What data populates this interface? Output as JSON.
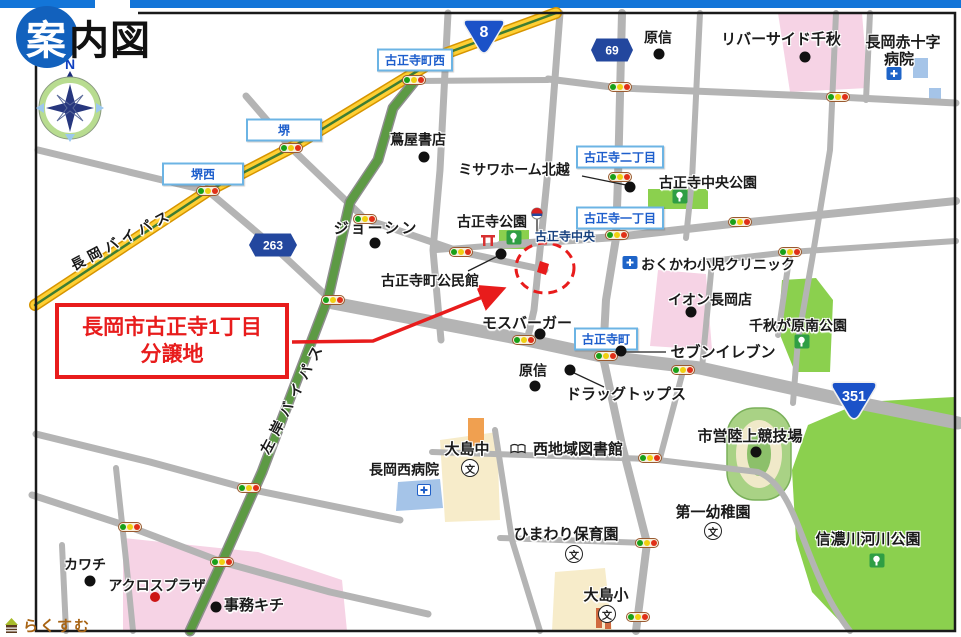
{
  "page": {
    "title_char1": "案",
    "title_rest": "内図",
    "logo_text": "らくすむ",
    "compass_north": "N"
  },
  "site_callout": {
    "line1": "長岡市古正寺1丁目",
    "line2": "分譲地"
  },
  "colors": {
    "accent_red": "#e81c1c",
    "route_shield_blue": "#1b52c8",
    "hex_shield_blue": "#23479e",
    "intersection_text_blue": "#1d5ecc",
    "intersection_border_blue": "#6cb4e4",
    "road_gray": "#b4b4b4",
    "bypass_yellow": "#ffcf33",
    "bypass_green": "#5d9a44",
    "park_green": "#8bd04e",
    "building_pink": "#f6d3e5",
    "building_cream": "#f7ecca",
    "building_blue": "#a5c4e8",
    "topbar_blue": "#1375d8",
    "title_circle_blue": "#1261bd"
  },
  "route_shields": [
    {
      "shape": "triangle",
      "num": "8",
      "x": 484,
      "y": 36,
      "w": 42,
      "h": 36,
      "fs": 16
    },
    {
      "shape": "triangle",
      "num": "351",
      "x": 854,
      "y": 400,
      "w": 52,
      "h": 40,
      "fs": 13
    },
    {
      "shape": "hex",
      "num": "69",
      "x": 612,
      "y": 50,
      "w": 42,
      "h": 23,
      "fs": 12
    },
    {
      "shape": "hex",
      "num": "263",
      "x": 273,
      "y": 245,
      "w": 48,
      "h": 23,
      "fs": 12
    }
  ],
  "intersections": [
    {
      "text": "古正寺町西",
      "x": 415,
      "y": 60
    },
    {
      "text": "堺",
      "x": 284,
      "y": 130,
      "w": 60
    },
    {
      "text": "堺西",
      "x": 203,
      "y": 174,
      "w": 66
    },
    {
      "text": "古正寺二丁目",
      "x": 620,
      "y": 157
    },
    {
      "text": "古正寺一丁目",
      "x": 620,
      "y": 218
    },
    {
      "text": "古正寺町",
      "x": 606,
      "y": 339
    }
  ],
  "places": [
    {
      "text": "長岡バイパス",
      "x": 122,
      "y": 240,
      "rot": -28,
      "ls": 5,
      "fs": 14,
      "name": "road-name-nagaoka-bypass"
    },
    {
      "text": "左岸バイパス",
      "x": 293,
      "y": 397,
      "rot": -63,
      "ls": 7,
      "fs": 14,
      "name": "road-name-sagan-bypass"
    },
    {
      "text": "古正寺中央",
      "x": 565,
      "y": 237,
      "fs": 12,
      "color": "#16407e",
      "name": "intersection-koshoji-chuo"
    },
    {
      "text": "蔦屋書店",
      "x": 418,
      "y": 140,
      "fs": 14
    },
    {
      "text": "ミサワホーム北越",
      "x": 514,
      "y": 170,
      "fs": 14
    },
    {
      "text": "原信",
      "x": 658,
      "y": 38,
      "fs": 14
    },
    {
      "text": "リバーサイド千秋",
      "x": 781,
      "y": 40,
      "fs": 15
    },
    {
      "text": "長岡赤十字",
      "x": 903,
      "y": 43,
      "fs": 15
    },
    {
      "text": "病院",
      "x": 899,
      "y": 60,
      "fs": 15
    },
    {
      "text": "ジョーシン",
      "x": 376,
      "y": 229,
      "fs": 15,
      "ls": 2
    },
    {
      "text": "古正寺中央公園",
      "x": 708,
      "y": 183,
      "fs": 14
    },
    {
      "text": "古正寺公園",
      "x": 492,
      "y": 222,
      "fs": 14
    },
    {
      "text": "古正寺町公民館",
      "x": 430,
      "y": 281,
      "fs": 14
    },
    {
      "text": "おくかわ小児クリニック",
      "x": 718,
      "y": 265,
      "fs": 14
    },
    {
      "text": "イオン長岡店",
      "x": 710,
      "y": 300,
      "fs": 14
    },
    {
      "text": "千秋が原南公園",
      "x": 798,
      "y": 326,
      "fs": 14
    },
    {
      "text": "モスバーガー",
      "x": 527,
      "y": 324,
      "fs": 15
    },
    {
      "text": "セブンイレブン",
      "x": 723,
      "y": 353,
      "fs": 15
    },
    {
      "text": "原信",
      "x": 533,
      "y": 371,
      "fs": 14
    },
    {
      "text": "ドラッグトップス",
      "x": 626,
      "y": 395,
      "fs": 15
    },
    {
      "text": "市営陸上競技場",
      "x": 750,
      "y": 437,
      "fs": 15
    },
    {
      "text": "大島中",
      "x": 467,
      "y": 450,
      "fs": 15
    },
    {
      "text": "西地域図書館",
      "x": 578,
      "y": 450,
      "fs": 15
    },
    {
      "text": "長岡西病院",
      "x": 404,
      "y": 470,
      "fs": 14
    },
    {
      "text": "ひまわり保育園",
      "x": 566,
      "y": 535,
      "fs": 15
    },
    {
      "text": "第一幼稚園",
      "x": 713,
      "y": 513,
      "fs": 15
    },
    {
      "text": "大島小",
      "x": 606,
      "y": 596,
      "fs": 15
    },
    {
      "text": "信濃川河川公園",
      "x": 868,
      "y": 540,
      "fs": 15
    },
    {
      "text": "カワチ",
      "x": 85,
      "y": 565,
      "fs": 14
    },
    {
      "text": "アクロスプラザ",
      "x": 157,
      "y": 586,
      "fs": 14
    },
    {
      "text": "事務キチ",
      "x": 254,
      "y": 606,
      "fs": 15
    }
  ],
  "poi_dots": [
    [
      424,
      157
    ],
    [
      630,
      187
    ],
    [
      659,
      54
    ],
    [
      805,
      57
    ],
    [
      375,
      243
    ],
    [
      501,
      254
    ],
    [
      691,
      312
    ],
    [
      540,
      334
    ],
    [
      621,
      351
    ],
    [
      535,
      386
    ],
    [
      570,
      370
    ],
    [
      756,
      452
    ],
    [
      90,
      581
    ],
    [
      216,
      607
    ]
  ],
  "red_dots": [
    [
      155,
      597
    ]
  ],
  "leader_lines": [
    [
      582,
      176,
      626,
      185
    ],
    [
      468,
      271,
      498,
      256
    ],
    [
      666,
      352,
      626,
      352
    ],
    [
      572,
      372,
      604,
      387
    ]
  ],
  "traffic_lights": [
    [
      291,
      148
    ],
    [
      208,
      191
    ],
    [
      414,
      80
    ],
    [
      620,
      87
    ],
    [
      838,
      97
    ],
    [
      620,
      177
    ],
    [
      617,
      235
    ],
    [
      740,
      222
    ],
    [
      790,
      252
    ],
    [
      365,
      219
    ],
    [
      461,
      252
    ],
    [
      333,
      300
    ],
    [
      524,
      340
    ],
    [
      606,
      356
    ],
    [
      683,
      370
    ],
    [
      249,
      488
    ],
    [
      130,
      527
    ],
    [
      222,
      562
    ],
    [
      647,
      543
    ],
    [
      638,
      617
    ],
    [
      650,
      458
    ]
  ],
  "icons": [
    {
      "type": "tree",
      "x": 680,
      "y": 199
    },
    {
      "type": "tree",
      "x": 514,
      "y": 240
    },
    {
      "type": "tree",
      "x": 802,
      "y": 344
    },
    {
      "type": "tree",
      "x": 877,
      "y": 563
    },
    {
      "type": "school",
      "x": 470,
      "y": 468
    },
    {
      "type": "school",
      "x": 574,
      "y": 554
    },
    {
      "type": "school",
      "x": 713,
      "y": 531
    },
    {
      "type": "school",
      "x": 607,
      "y": 614
    },
    {
      "type": "hospital",
      "x": 894,
      "y": 76
    },
    {
      "type": "hospital",
      "x": 630,
      "y": 265
    },
    {
      "type": "clinic-white",
      "x": 424,
      "y": 492
    },
    {
      "type": "book",
      "x": 518,
      "y": 450
    },
    {
      "type": "busstop",
      "x": 537,
      "y": 222
    },
    {
      "type": "gate",
      "x": 488,
      "y": 242
    }
  ]
}
